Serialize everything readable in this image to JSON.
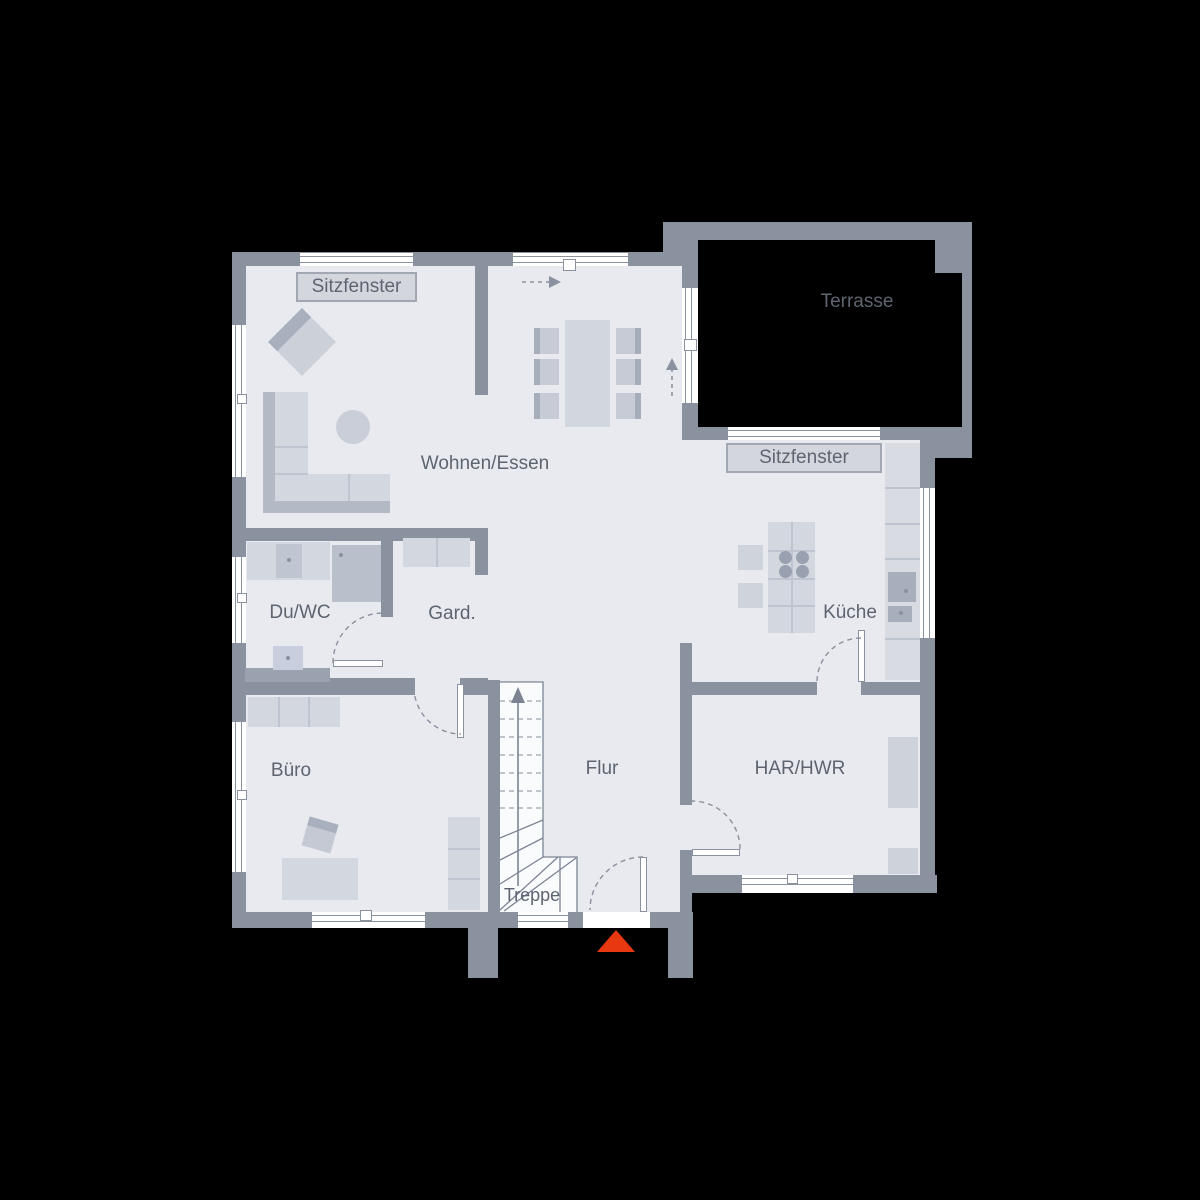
{
  "labels": {
    "living_dining": "Wohnen/Essen",
    "shower_wc": "Du/WC",
    "wardrobe": "Gard.",
    "kitchen": "Küche",
    "office": "Büro",
    "hallway": "Flur",
    "utility": "HAR/HWR",
    "stairs": "Treppe",
    "terrace": "Terrasse",
    "seat_window_top": "Sitzfenster",
    "seat_window_right": "Sitzfenster"
  },
  "colors": {
    "background": "#000000",
    "wall": "#8a919f",
    "floor": "#e8eaef",
    "furniture": "#d3d7df",
    "furniture_dark": "#aeb5c2",
    "label_text": "#5e6470",
    "label_box_bg": "#d3d6dd",
    "label_box_border": "#a2a8b3",
    "line": "#7c8494",
    "window": "#ffffff",
    "entrance_marker": "#e8380f"
  }
}
